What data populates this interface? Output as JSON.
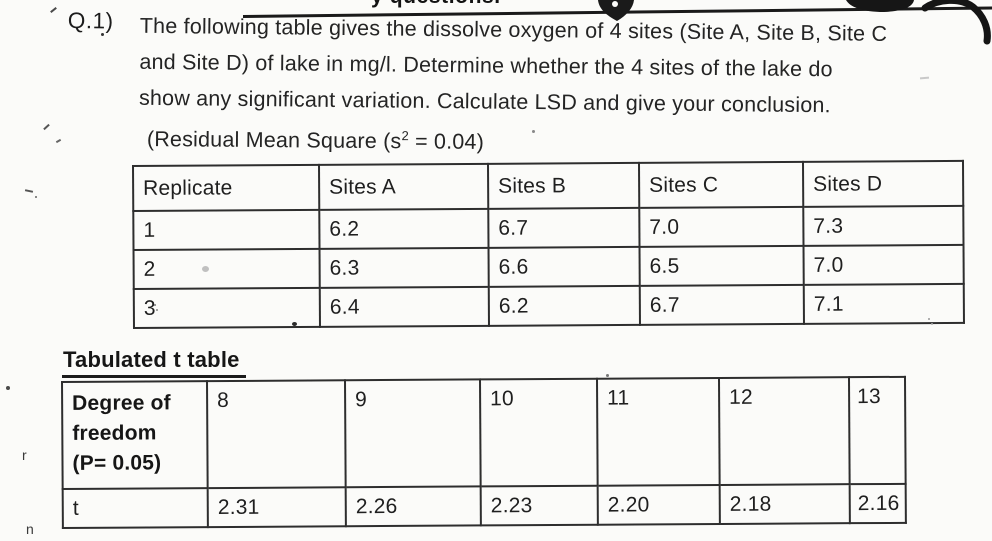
{
  "colors": {
    "paper": "#fbfbf9",
    "ink": "#222222",
    "table_border": "#2e2e2e"
  },
  "top_strip": {
    "clipped_text": "y questions."
  },
  "question": {
    "number": "Q.1)",
    "lines": [
      "The following table gives the dissolve oxygen of 4 sites (Site A, Site B, Site C",
      "and Site D) of lake in mg/l. Determine whether the 4 sites of the lake do",
      "show any significant variation. Calculate LSD and give your conclusion."
    ],
    "residual_note": {
      "prefix": "(Residual Mean Square (s",
      "superscript": "2",
      "suffix": " = 0.04)"
    }
  },
  "oxygen_table": {
    "headers": [
      "Replicate",
      "Sites A",
      "Sites B",
      "Sites C",
      "Sites D"
    ],
    "rows": [
      [
        "1",
        "6.2",
        "6.7",
        "7.0",
        "7.3"
      ],
      [
        "2",
        "6.3",
        "6.6",
        "6.5",
        "7.0"
      ],
      [
        "3",
        "6.4",
        "6.2",
        "6.7",
        "7.1"
      ]
    ]
  },
  "t_table": {
    "title": "Tabulated t table",
    "row_header_lines": [
      "Degree of",
      "freedom",
      "(P= 0.05)"
    ],
    "degrees_of_freedom": [
      "8",
      "9",
      "10",
      "11",
      "12",
      "13"
    ],
    "t_row_label": "t",
    "t_values": [
      "2.31",
      "2.26",
      "2.23",
      "2.20",
      "2.18",
      "2.16"
    ]
  },
  "scan_marks": {
    "glyphs": [
      "r",
      "n"
    ]
  }
}
